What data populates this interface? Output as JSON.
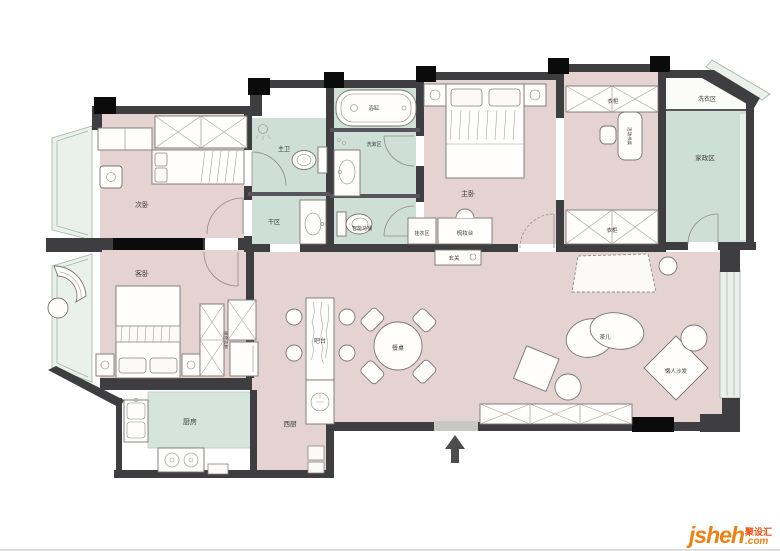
{
  "labels": {
    "bedroom2": "次卧",
    "master_bath": "主卫",
    "dry_area": "干区",
    "bathtub": "浴缸",
    "wash_area": "洗漱区",
    "smart_toilet": "智能马桶",
    "master_bedroom": "主卧",
    "wardrobe_top": "衣柜",
    "wardrobe_bottom": "衣柜",
    "movable_desk": "活动书桌",
    "laundry_zone": "洗衣区",
    "utility_room": "家政区",
    "entry_hall": "玄关",
    "hanging_zone": "挂衣区",
    "dressing_table": "梳妆台",
    "guest_bedroom": "客卧",
    "combo_wardrobe": "组合衣柜",
    "bar_counter": "吧台",
    "dining_table": "餐桌",
    "kitchen": "厨房",
    "west_kitchen": "西厨",
    "tea_table": "茶几",
    "lazy_sofa": "懒人沙发"
  },
  "branding": {
    "logo": "jsheh",
    "tld": ".com",
    "cn": "聚设汇"
  },
  "colors": {
    "room_pink": "#e5d3d2",
    "room_green": "#cddfd6",
    "kitchen_green": "#d5e4dc",
    "laundry_white": "#fbfbf8",
    "window_tint": "#eaf1ec",
    "wall": "#3e3e40",
    "wall_black": "#0b0b0b",
    "entry_gap": "#c7c7c5",
    "logo_orange": "#f08011",
    "logo_red": "#ee4b0e"
  }
}
